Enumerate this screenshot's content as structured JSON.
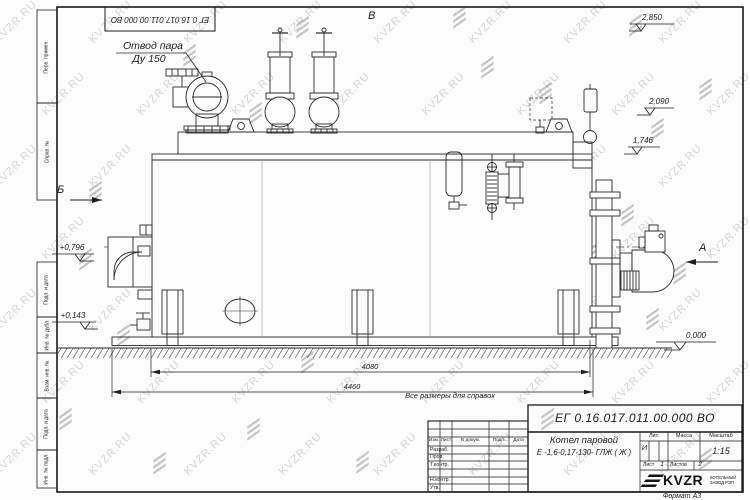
{
  "watermark": {
    "text": "KVZR.RU"
  },
  "doc": {
    "number": "ЕГ 0.16.017.011.00.000  ВО"
  },
  "callouts": {
    "steam_line1": "Отвод пара",
    "steam_line2": "Ду 150",
    "view_top": "В",
    "view_left": "Б",
    "view_right": "А",
    "note": "Все размеры для справок",
    "format": "Формат А3"
  },
  "levels": {
    "l2850": "2,850",
    "l2090": "2,090",
    "l1746": "1,746",
    "l0796": "+0,796",
    "l0143": "+0,143",
    "l0000": "0,000"
  },
  "dims": {
    "inner": "4080",
    "outer": "4460"
  },
  "margin_stamps": {
    "perv": "Перв. примен.",
    "sprav": "Справ. №",
    "podp1": "Подп. и дата",
    "inv_dubl": "Инв. № дубл.",
    "vzam": "Взам. инв. №",
    "podp2": "Подп. и дата",
    "inv_podl": "Инв. № подл."
  },
  "title_block": {
    "doc_number": "ЕГ 0.16.017.011.00.000  ВО",
    "name1": "Котел паровой",
    "name2": "Е -1,6-0,17-130- ГЛЖ ( Ж )",
    "col_izm": "Изм.",
    "col_list": "Лист",
    "col_ndoc": "N докум.",
    "col_podp": "Подп.",
    "col_data": "Дата",
    "row_razrab": "Разраб.",
    "row_prov": "Пров.",
    "row_tkontr": "Т.контр.",
    "row_nkontr": "Н.контр.",
    "row_utv": "Утв.",
    "lit_label": "Лит.",
    "lit_value": "И",
    "massa_label": "Масса",
    "scale_label": "Масштаб",
    "scale_value": "1:15",
    "sheet_label": "Лист",
    "sheet_value": "1",
    "sheets_label": "Листов",
    "sheets_value": "2",
    "logo_text": "KVZR",
    "logo_sub1": "КОТЕЛЬНЫЙ",
    "logo_sub2": "ЗАВОД РЭП"
  }
}
